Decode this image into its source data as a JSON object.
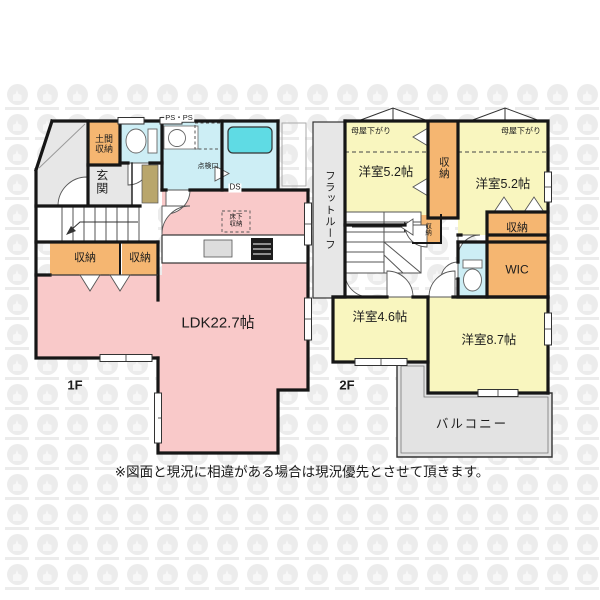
{
  "floor1": {
    "label": "1F",
    "ldk": "LDK22.7帖",
    "genkan": "玄関",
    "doma_storage": "土間収納",
    "closet_a": "収納",
    "closet_b": "収納",
    "underfloor_storage": "床下収納",
    "inspection_port": "点検口",
    "pipe_space": "PS・PS",
    "duct_space": "DS"
  },
  "floor2": {
    "label": "2F",
    "flat_roof": "フラットルーフ",
    "bedroom_nw": "洋室5.2帖",
    "bedroom_ne": "洋室5.2帖",
    "bedroom_sw": "洋室4.6帖",
    "bedroom_se": "洋室8.7帖",
    "moya_sagari_left": "母屋下がり",
    "moya_sagari_right": "母屋下がり",
    "closet_mid": "収納",
    "closet_stair": "収納",
    "closet_east": "収納",
    "wic": "WIC",
    "balcony": "バルコニー"
  },
  "footer": {
    "disclaimer": "※図面と現況に相違がある場合は現況優先とさせて頂きます。"
  },
  "colors": {
    "room_pink": "#f9c9c9",
    "room_yellow": "#f9f6bf",
    "storage_orange": "#f5b671",
    "wet_cyan": "#cdeef5",
    "tub_teal": "#5fdbe4",
    "gray_area": "#e7e7e7",
    "wall": "#161616"
  }
}
